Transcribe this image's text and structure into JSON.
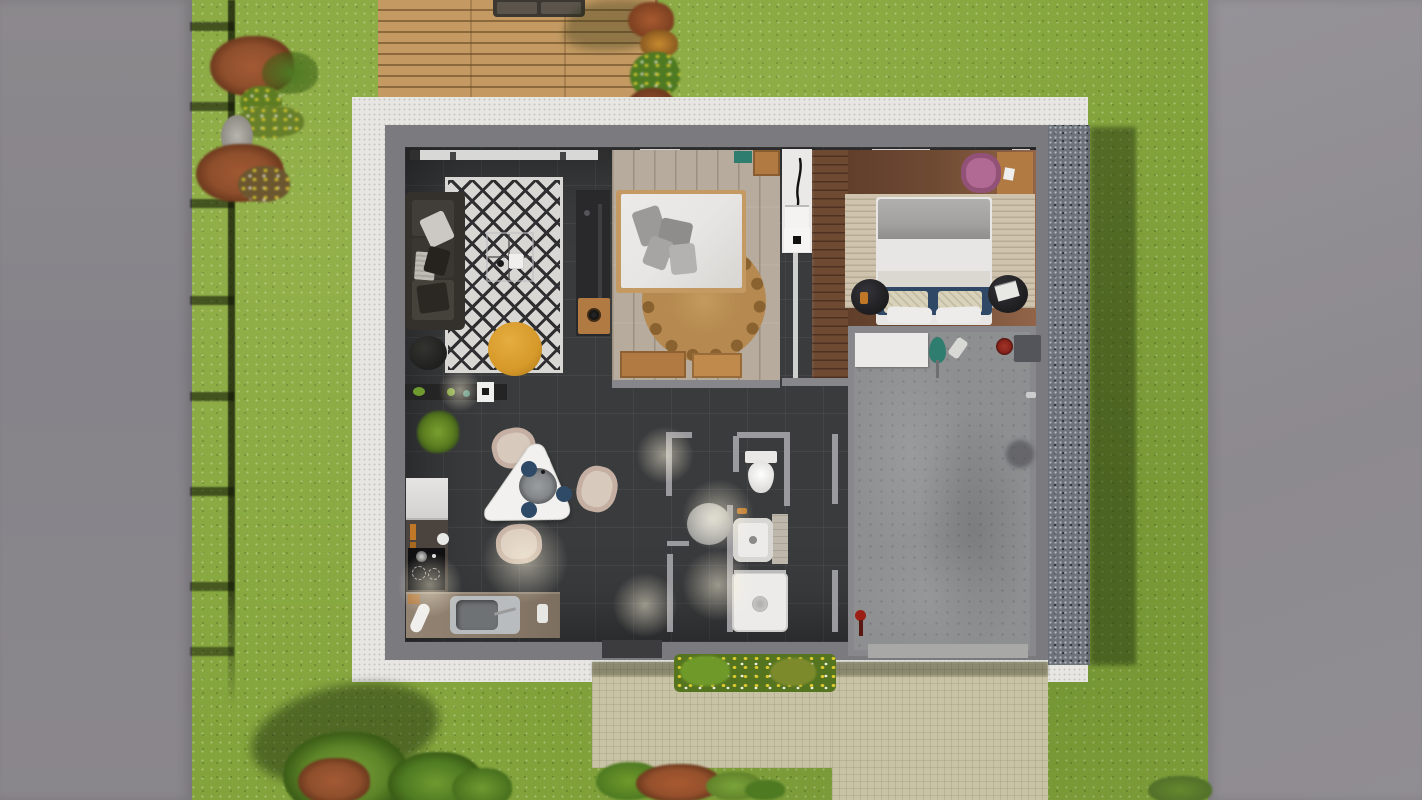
{
  "meta": {
    "kind": "3D architectural floor plan, top-down render",
    "canvas": {
      "width": 1422,
      "height": 800
    }
  },
  "palette": {
    "grass": "#83a43c",
    "roadLeft": "#89868a",
    "roadRight": "#8f8c91",
    "deckWood": "#c49a62",
    "apron": "#e7e6e2",
    "gravel": "#6d727b",
    "wall": "#7b7a7e",
    "wallLight": "#9b9a9e",
    "floorDark": "#3a3b3d",
    "livingRugBase": "#d9d7d3",
    "livingRugInk": "#2f2f31",
    "sofaDark": "#34312d",
    "poufYellow": "#d6992a",
    "poufBlack": "#1f1f1f",
    "woodMid": "#b07a42",
    "bed1Frame": "#c59a62",
    "duvetWhite": "#e7e6e4",
    "pillowGray": "#9b9a98",
    "floorBed1": "#b6ab9c",
    "floorBed2": "#6f4a33",
    "jute": "#b5894f",
    "juteDark": "#8a6230",
    "divider": "#eae9e7",
    "tealAccent": "#2f7d6e",
    "pinkChair": "#b16a93",
    "rugBeige": "#cfc3ad",
    "bedGray": "#a3a2a0",
    "navy": "#2e4866",
    "pillowCheck": "#d9d2ba",
    "nightBlack": "#1d1d1f",
    "concrete": "#8e8f91",
    "bench": "#eceae8",
    "redItem": "#8a241c",
    "counterDark": "#4b443e",
    "hob": "#101012",
    "steel": "#b9bcbe",
    "counterWood": "#8c7c6b",
    "tableWhite": "#f2f1ef",
    "tray": "#84878a",
    "plateNavy": "#2f4a66",
    "chairBeige": "#d8c9bd",
    "showerWhite": "#ecebe9",
    "pathBeige": "#c9c3a5",
    "flowerYellow": "#decb2e",
    "flowerWhite": "#efefe8",
    "bushRed": "#8f4f2c",
    "treeGreen": "#5d8428"
  },
  "environment": {
    "left_road": {
      "label": "Paved road, left boundary"
    },
    "right_road": {
      "label": "Paved road, right boundary"
    },
    "lawn": {
      "label": "Lawn with wildflower speckles"
    },
    "fence": {
      "label": "Fence shadow along left boundary",
      "rungs": 8
    },
    "deck": {
      "label": "Wooden deck terrace",
      "furniture": [
        "outdoor sofa"
      ]
    },
    "apron": {
      "label": "Light concrete apron around the house"
    },
    "gravel_strip": {
      "label": "Gravel drainage strip, right side of house"
    },
    "front_path": {
      "label": "Paved front path and driveway"
    },
    "flower_bed": {
      "label": "Flower bed at the entrance"
    },
    "planting": [
      "red shrubs",
      "green shrubs",
      "garden stone",
      "trees with cast shadows"
    ]
  },
  "house": {
    "label": "Single-storey house, top-down view",
    "rooms": [
      {
        "id": "living-room",
        "label": "Living room",
        "furniture": [
          "corner sofa",
          "black-and-white diamond rug",
          "glass coffee table",
          "TV sideboard",
          "wooden side table",
          "yellow pouf",
          "black pouf",
          "wall shelf",
          "potted plant",
          "window"
        ]
      },
      {
        "id": "bedroom-1",
        "label": "Bedroom 1",
        "furniture": [
          "double bed with white duvet",
          "grey pillows",
          "round jute rug",
          "wooden dresser",
          "wooden crate",
          "teal bench"
        ]
      },
      {
        "id": "bedroom-2",
        "label": "Bedroom 2",
        "furniture": [
          "double bed with navy throw",
          "checked pillows",
          "beige rug",
          "round black nightstands",
          "desk",
          "pink chair",
          "white wardrobe with decor"
        ]
      },
      {
        "id": "bathroom",
        "label": "Bathroom",
        "furniture": [
          "washbasin",
          "walk-in shower",
          "round grey mat",
          "tiled splashback"
        ]
      },
      {
        "id": "wc",
        "label": "WC",
        "furniture": [
          "toilet"
        ]
      },
      {
        "id": "kitchen",
        "label": "Kitchen",
        "furniture": [
          "white appliance cabinet",
          "induction hob",
          "worktop with steel sink",
          "rolled towel",
          "spice jars"
        ]
      },
      {
        "id": "dining",
        "label": "Dining corner",
        "furniture": [
          "triangular white table",
          "grey serving tray",
          "navy plates",
          "three beige chairs"
        ]
      },
      {
        "id": "hallway",
        "label": "Hallway",
        "furniture": [
          "ceiling light pools"
        ]
      },
      {
        "id": "garage",
        "label": "Garage / utility room",
        "furniture": [
          "white workbench",
          "teal garden tool",
          "red bucket",
          "dark floor mat",
          "floor stain",
          "red valve",
          "garage door threshold"
        ]
      }
    ]
  }
}
